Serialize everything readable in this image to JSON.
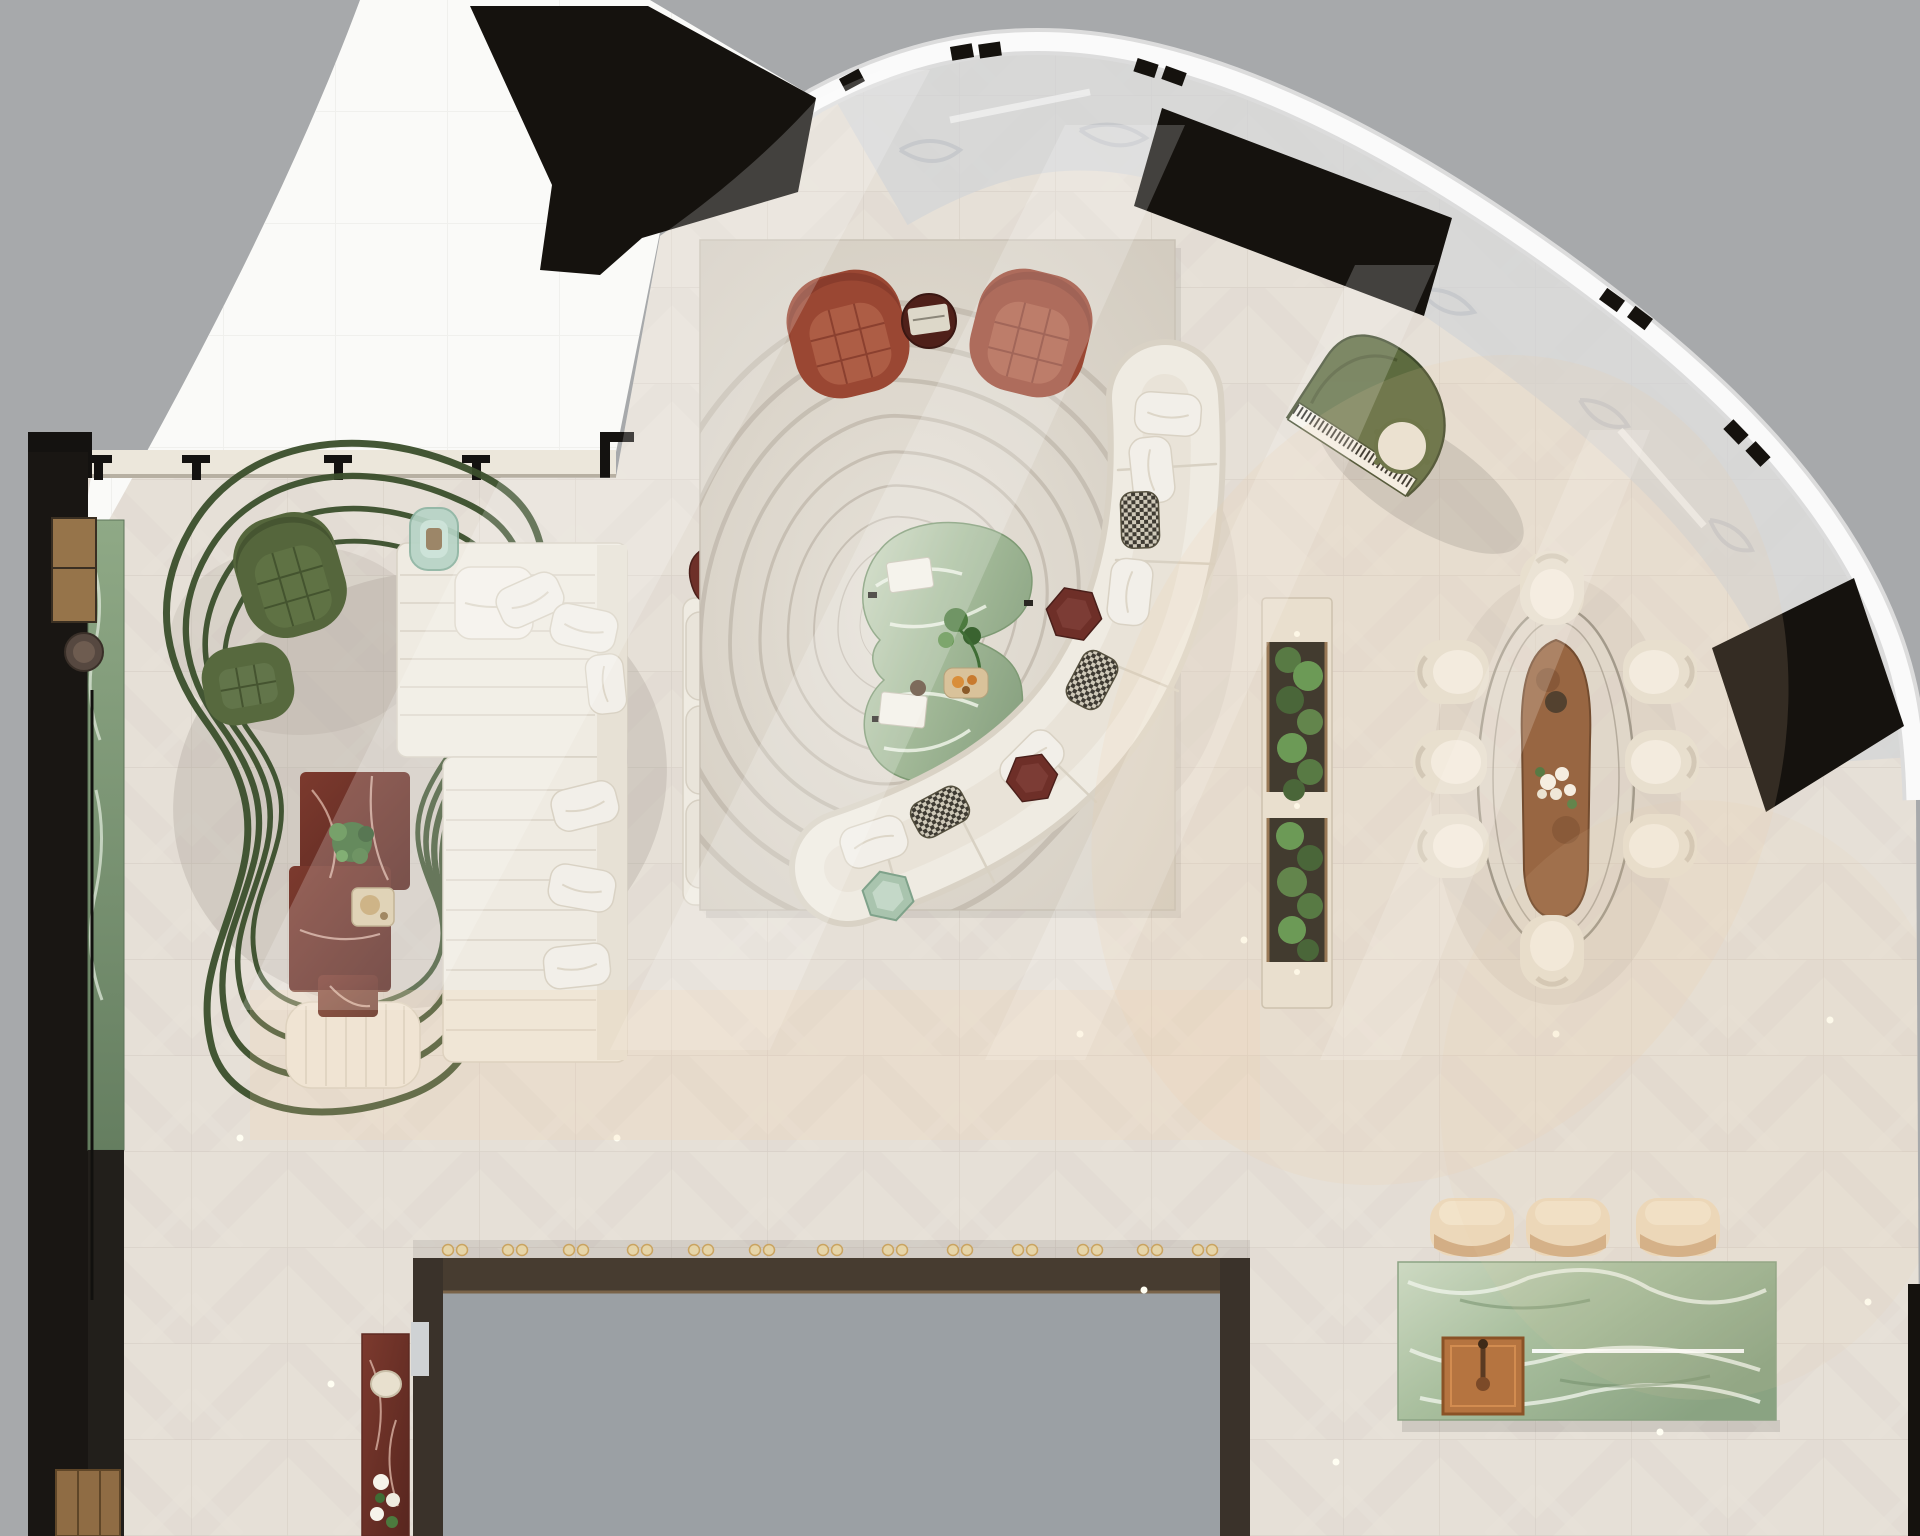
{
  "scene": {
    "title": "Penthouse living area — top-down interior render",
    "view": "top-down 3D floor plan",
    "rooms": "living lounge, piano corner, dining, kitchen island bar, terrace"
  },
  "colors": {
    "outside": "#a7a9ab",
    "terrace": "#fafaf8",
    "floor": "#e6e0d7",
    "tile_line": "#cdc5bb",
    "arc_band": "#fafafa",
    "glass_marble": "#d2d4d7",
    "black_panel": "#15120e",
    "sill": "#ece7db",
    "media_black": "#191613",
    "console_green": "#7f9878",
    "bronze": "#96744a",
    "rug": "#dcd5ca",
    "rug_line": "#c3bbaf",
    "sofa": "#efebe2",
    "sofa_shadow": "#d8d1c4",
    "pillow_white": "#f2efe9",
    "pillow_pattern_dark": "#3e3a32",
    "chair_rust": "#9a4733",
    "chair_rust_inner": "#ad5d45",
    "chair_olive": "#55663c",
    "squiggle_green": "#3b4f2c",
    "ottoman": "#efe9de",
    "red_marble": "#713329",
    "dark_red_marble": "#4f2019",
    "mint_glass": "#b7d4c6",
    "green_marble": "#a9bf9e",
    "piano_green": "#5d6b3f",
    "plant_green": "#3f6d35",
    "soil": "#26231d",
    "dining_chair": "#e7e2d6",
    "runner_brown": "#8a5633",
    "flower_white": "#f6f3ea",
    "island_green": "#b2c5a7",
    "copper": "#b57440",
    "stool": "#ecd8ba",
    "void_gray": "#9ba0a4",
    "frame_bronze": "#473c30",
    "glassware_gold": "#caa25c",
    "led": "#fffef2"
  },
  "furniture": {
    "terrace": "open terrace (bright daylight)",
    "media_wall": "left media wall with green marble console and bronze shelves",
    "swivel_chairs_olive": "two olive tufted swivel chairs on green line rug",
    "line_rug": "dark-green looping line rug",
    "left_sofa_group": "L-shaped cream modular sofa with poufs and pillows",
    "red_marble_table": "stepped red marble coffee table with plant and tray",
    "ottoman_bench": "cream channel-stitched ottoman",
    "center_sofa": "straight cream sofa with back cushions",
    "area_rug": "large carved rug with concentric organic lines",
    "accent_chairs_rust": "two rust barrel armchairs with round marble side table",
    "green_coffee_table": "organic green marble coffee table with books and plant",
    "curved_sofa": "long curved cream sectional with patterned pillows and marble hex tables",
    "grand_piano": "olive green grand piano with round stool",
    "planter": "double planter bed with lush greenery",
    "dining_set": "oval glass dining table, brown runner with flowers, 8 cream tub chairs",
    "kitchen_island": "green marble island with copper sink and LED strip",
    "bar_stools": "three cream bar stools",
    "bar_void": "double-height void with bronze frame and glassware bar rail",
    "red_console": "red marble console with bowl and white flowers"
  }
}
